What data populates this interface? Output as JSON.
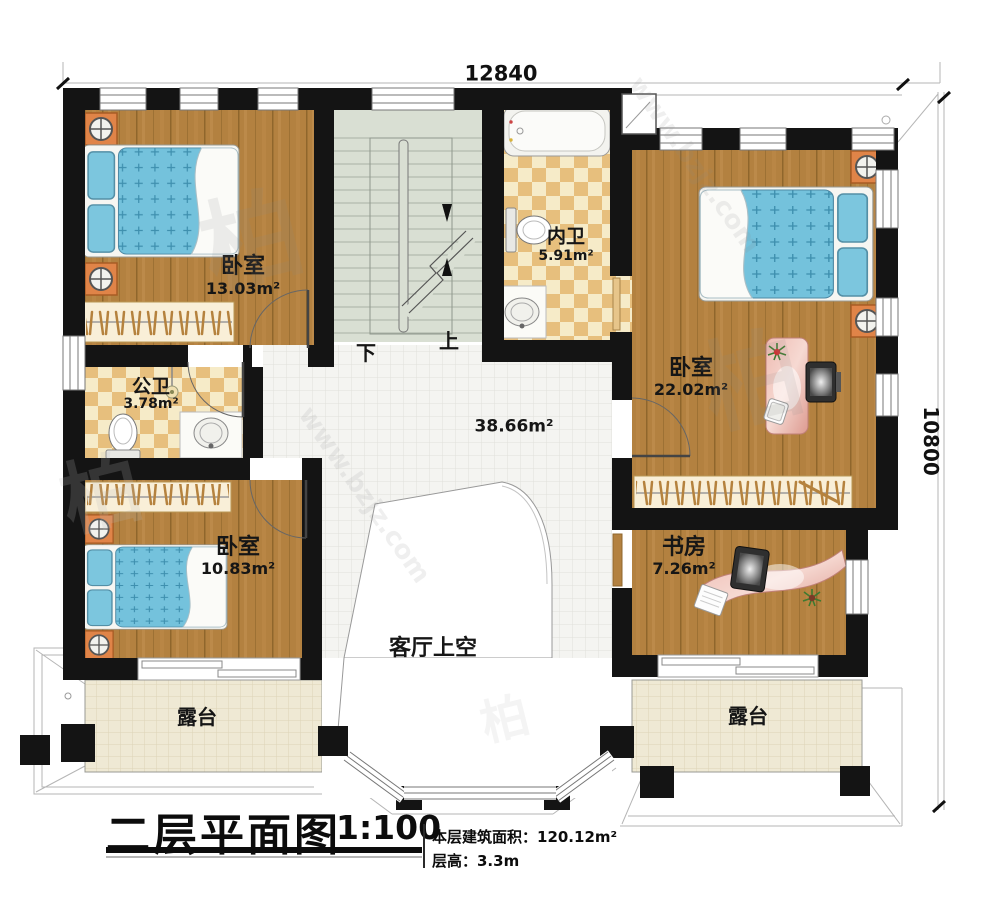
{
  "dimensions": {
    "top": "12840",
    "right": "10800"
  },
  "stairs": {
    "down": "下",
    "up": "上"
  },
  "rooms": {
    "bedroom_top_left": {
      "name": "卧室",
      "area": "13.03m²"
    },
    "bath_inner": {
      "name": "内卫",
      "area": "5.91m²"
    },
    "bedroom_right": {
      "name": "卧室",
      "area": "22.02m²"
    },
    "bath_public": {
      "name": "公卫",
      "area": "3.78m²"
    },
    "bedroom_bottom_left": {
      "name": "卧室",
      "area": "10.83m²"
    },
    "study": {
      "name": "书房",
      "area": "7.26m²"
    },
    "hall": {
      "area": "38.66m²"
    },
    "living_void": {
      "name": "客厅上空"
    },
    "terrace_left": {
      "name": "露台"
    },
    "terrace_right": {
      "name": "露台"
    }
  },
  "title_block": {
    "title": "二层平面图",
    "scale": "1:100",
    "floor_area": "本层建筑面积：120.12m²",
    "floor_height": "层高：3.3m"
  },
  "watermark": {
    "char": "柏",
    "url": "www.bzjz.com"
  },
  "colors": {
    "wall": "#141414",
    "wood": "#b38140",
    "tile_check_dark": "#e7bf7d",
    "stair": "#d9dfd3",
    "mattress": "#74c2dc",
    "terrace": "#efe9d4",
    "desk": "#e4a89e"
  }
}
